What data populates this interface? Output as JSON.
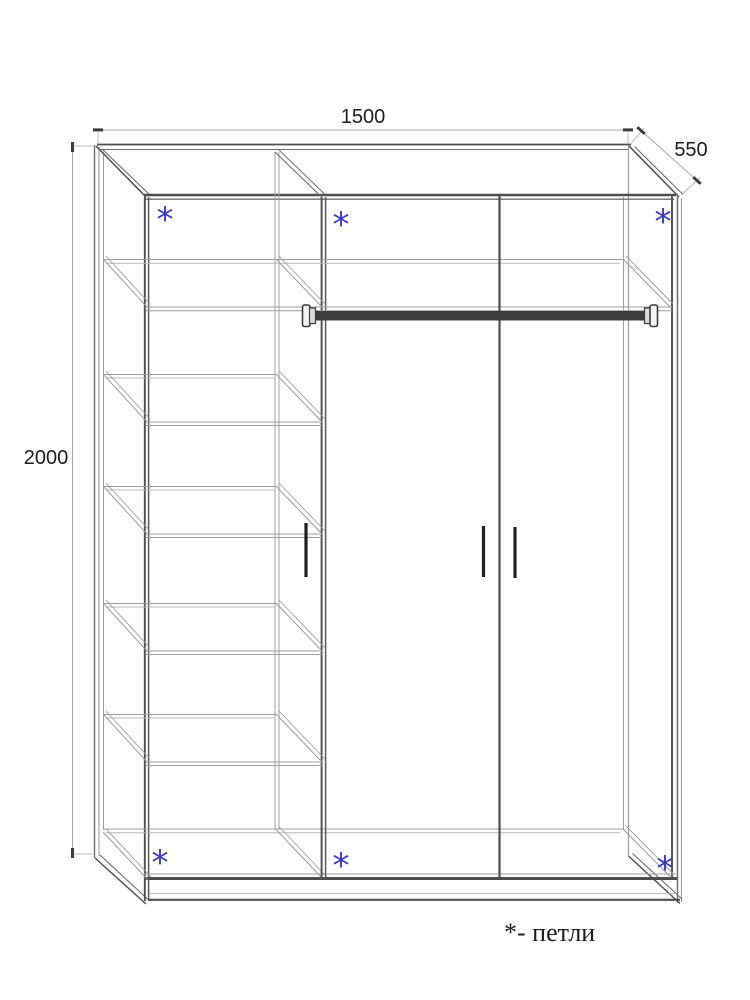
{
  "page": {
    "background": "#ffffff",
    "type": "furniture-technical-drawing"
  },
  "legend": {
    "text": "*- петли"
  },
  "dimensions": {
    "width_label": "1500",
    "depth_label": "550",
    "height_label": "2000"
  },
  "annotations": {
    "hinge_symbol": "*",
    "hinge_positions": [
      {
        "x": 165,
        "y": 215
      },
      {
        "x": 341,
        "y": 220
      },
      {
        "x": 663,
        "y": 217
      },
      {
        "x": 160,
        "y": 858
      },
      {
        "x": 341,
        "y": 861
      },
      {
        "x": 665,
        "y": 864
      }
    ]
  },
  "colors": {
    "line_dark": "#4e4e4e",
    "line_mid": "#6e6e6e",
    "line_light": "#9c9c9c",
    "line_faint": "#b8b8b8",
    "dim_line": "#a8a8a8",
    "tick": "#3a3a3a",
    "text": "#1d1d1d",
    "hinge": "#3a3ab8",
    "handle": "#1f1f1f",
    "rod": "#3d3d3d"
  },
  "wardrobe": {
    "geometry": {
      "front": {
        "left": 146,
        "top": 196,
        "right": 672,
        "bottom": 878
      },
      "outer_back": {
        "left": 94.5,
        "top": 145,
        "right": 628.5,
        "bottom": 857
      },
      "partition_front_x": 322,
      "partition_back_x": 275,
      "door_divider_x": 499.5,
      "floor_back_y": 829,
      "plinth_bottom_y": 900,
      "top_shelf": {
        "front_y": 308,
        "back_y": 259
      },
      "left_shelf_front_ys": [
        423,
        535,
        652,
        763
      ],
      "shelf_depth_dy": 49,
      "rod": {
        "x1": 314,
        "x2": 646,
        "y": 311,
        "h": 9.5
      },
      "handles": [
        {
          "x": 306,
          "y1": 523,
          "y2": 577
        },
        {
          "x": 483.5,
          "y1": 526,
          "y2": 577
        },
        {
          "x": 515,
          "y1": 527,
          "y2": 578
        }
      ]
    }
  }
}
